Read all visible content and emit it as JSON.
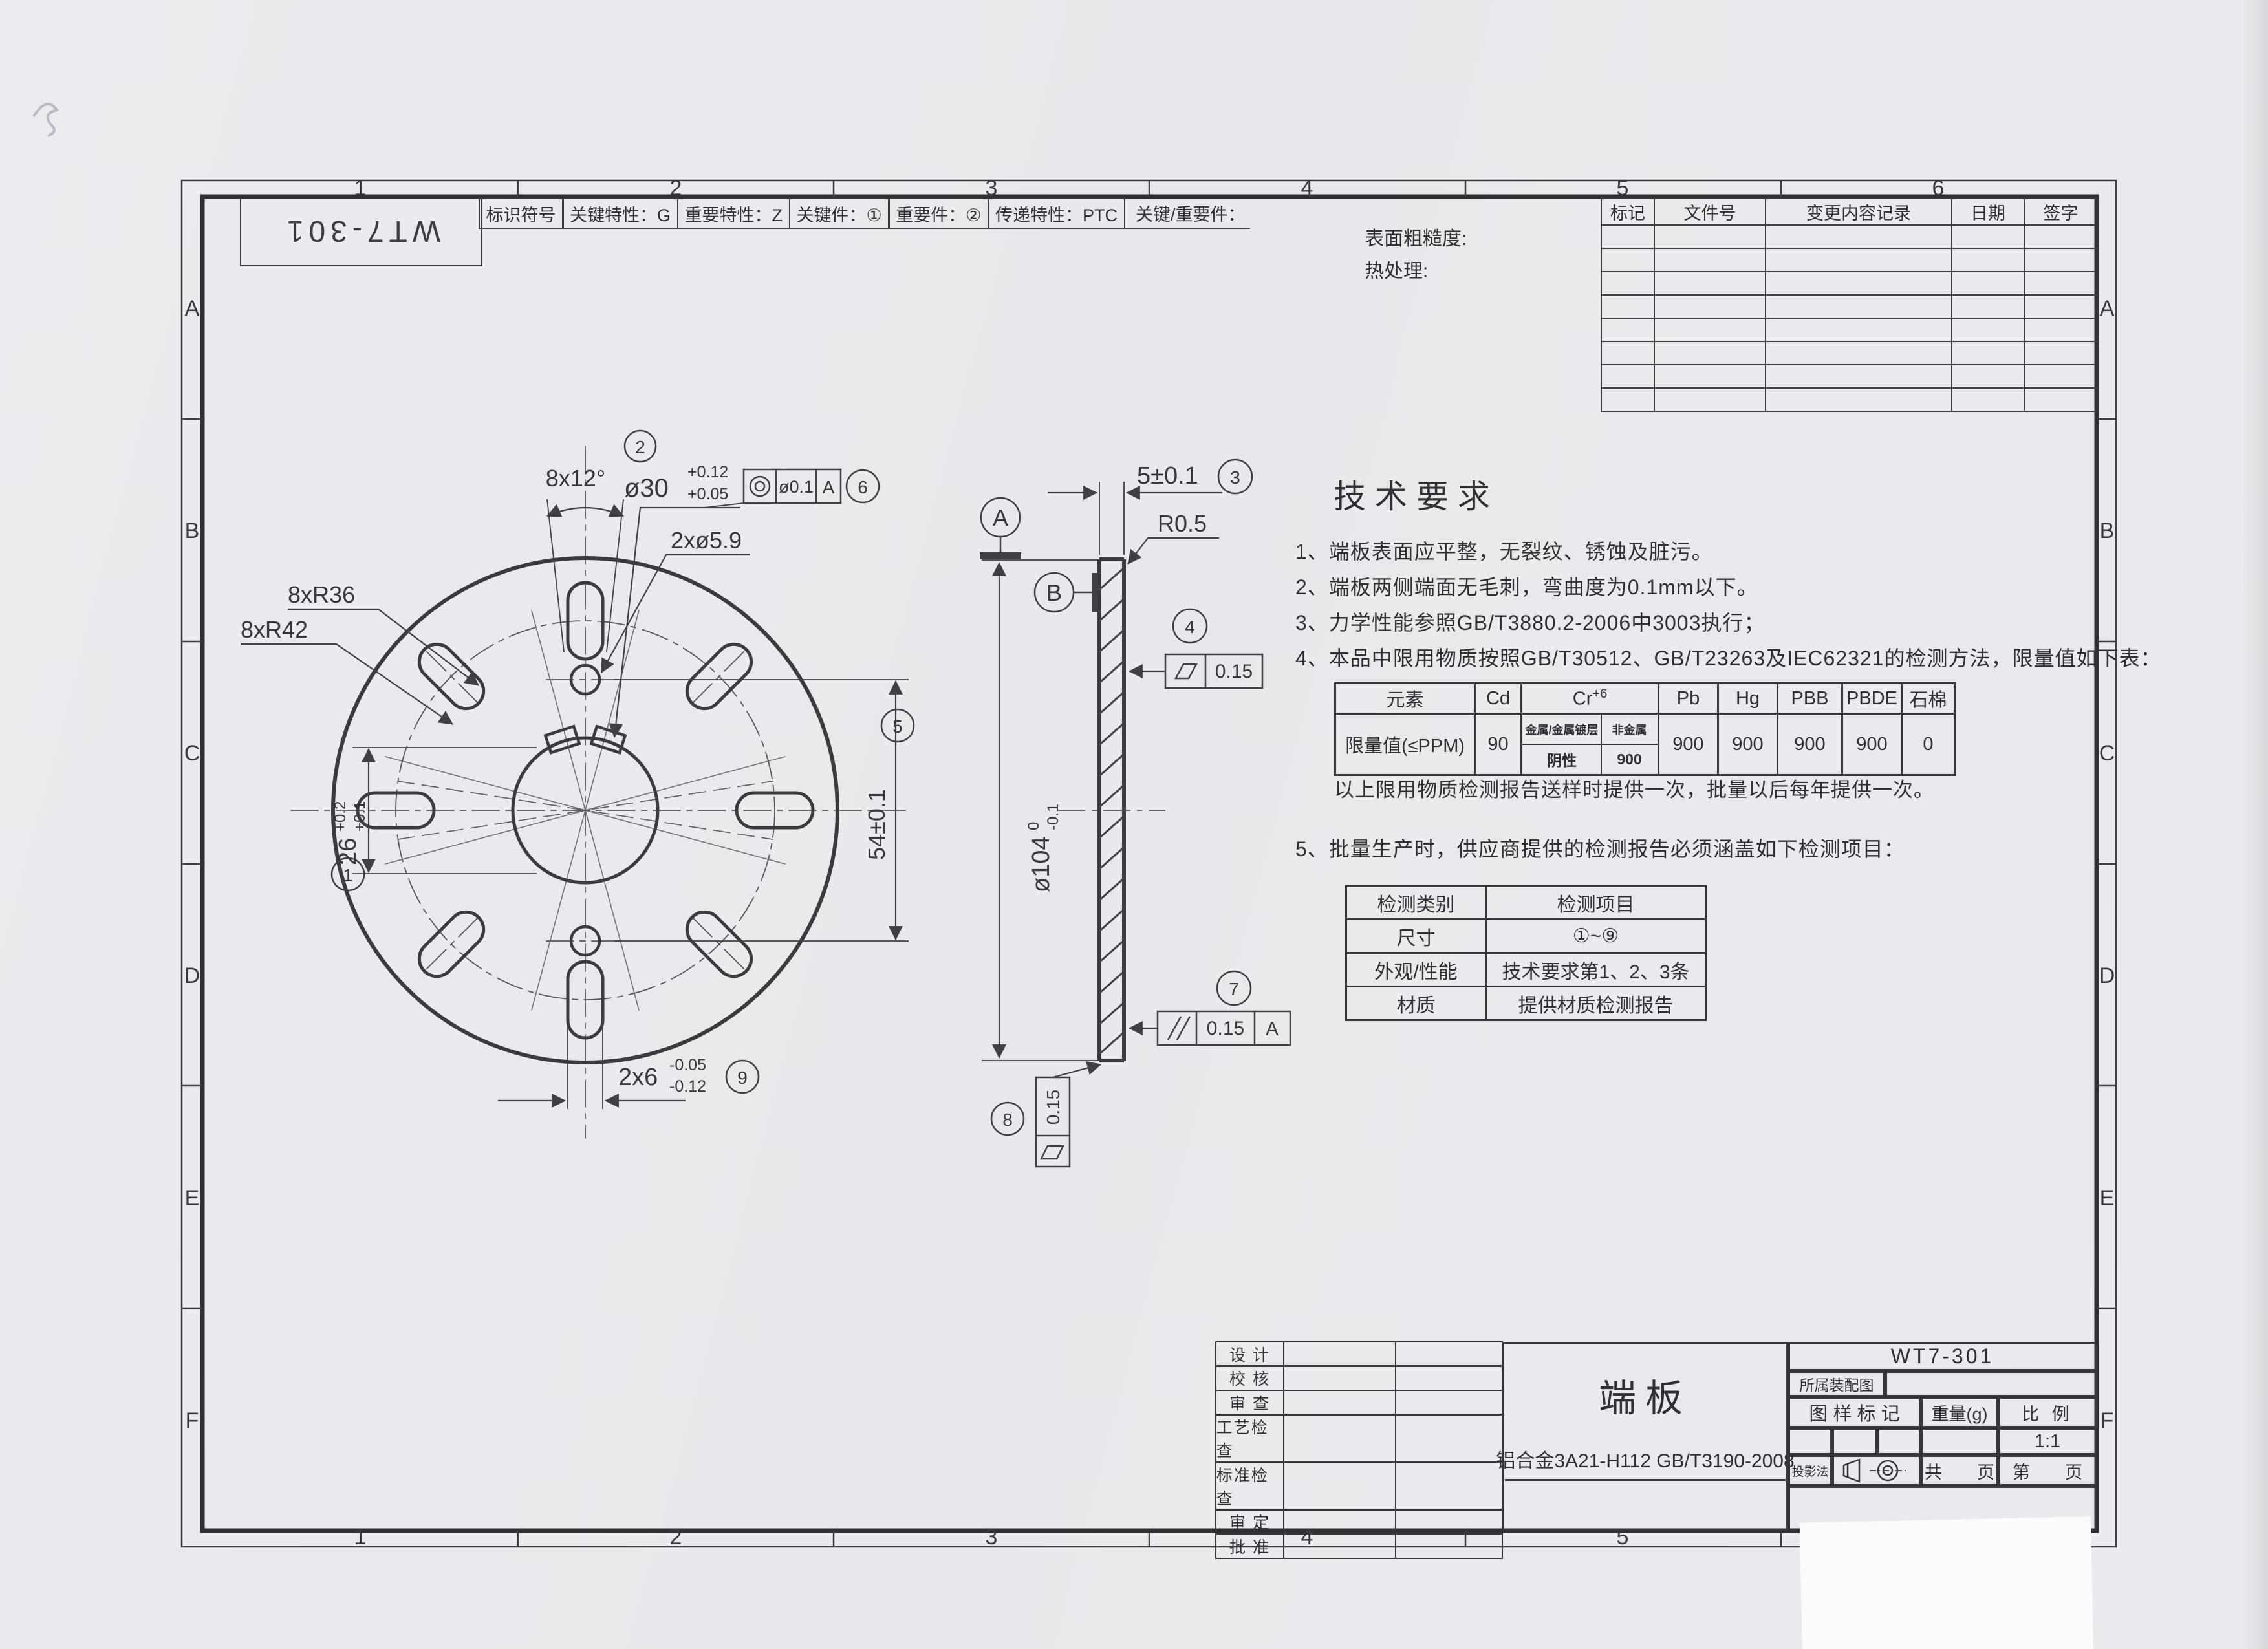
{
  "frame": {
    "zone_cols": [
      "1",
      "2",
      "3",
      "4",
      "5",
      "6"
    ],
    "zone_rows": [
      "A",
      "B",
      "C",
      "D",
      "E",
      "F"
    ],
    "corner_code": "WT7-301"
  },
  "header_strip": {
    "cells": [
      "标识符号",
      "关键特性：G",
      "重要特性：Z",
      "关键件：①",
      "重要件：②",
      "传递特性：PTC"
    ],
    "tail": "关键/重要件："
  },
  "revision_table": {
    "headers": [
      "标记",
      "文件号",
      "变更内容记录",
      "日期",
      "签字"
    ]
  },
  "notes_top": {
    "surface": "表面粗糙度:",
    "heat": "热处理:"
  },
  "tech_req": {
    "title": "技术要求",
    "items": [
      "1、端板表面应平整，无裂纹、锈蚀及脏污。",
      "2、端板两侧端面无毛刺，弯曲度为0.1mm以下。",
      "3、力学性能参照GB/T3880.2-2006中3003执行；",
      "4、本品中限用物质按照GB/T30512、GB/T23263及IEC62321的检测方法，限量值如下表："
    ],
    "item5": "5、批量生产时，供应商提供的检测报告必须涵盖如下检测项目："
  },
  "rohs_table": {
    "h_element": "元素",
    "h_cd": "Cd",
    "h_cr_base": "Cr",
    "h_cr_sup": "+6",
    "h_pb": "Pb",
    "h_hg": "Hg",
    "h_pbb": "PBB",
    "h_pbde": "PBDE",
    "h_asbestos": "石棉",
    "row_label": "限量值(≤PPM)",
    "cd_value": "90",
    "cr_sub_headers": [
      "金属/金属镀层",
      "非金属"
    ],
    "cr_values": [
      "阴性",
      "900"
    ],
    "values": [
      "900",
      "900",
      "900",
      "900",
      "0"
    ],
    "note": "以上限用物质检测报告送样时提供一次，批量以后每年提供一次。"
  },
  "inspection_table": {
    "headers": [
      "检测类别",
      "检测项目"
    ],
    "rows": [
      [
        "尺寸",
        "①~⑨"
      ],
      [
        "外观/性能",
        "技术要求第1、2、3条"
      ],
      [
        "材质",
        "提供材质检测报告"
      ]
    ]
  },
  "title_block": {
    "sig_rows": [
      "设 计",
      "校 核",
      "审 查",
      "工艺检查",
      "标准检查",
      "审 定",
      "批 准"
    ],
    "part_name": "端板",
    "material": "铝合金3A21-H112 GB/T3190-2008",
    "drawing_no": "WT7-301",
    "assembly_label": "所属装配图",
    "mark_label": "图 样 标 记",
    "weight_label": "重量(g)",
    "scale_label": "比 例",
    "scale_value": "1:1",
    "projection_label": "投影法",
    "pages_total": "共　　页",
    "page_no": "第　　页"
  },
  "dims": {
    "slot_angle": "8x12°",
    "bore_balloon": "2",
    "bore_dim": "ø30",
    "bore_tol_up": "+0.12",
    "bore_tol_dn": "+0.05",
    "conc_tol": "ø0.1",
    "conc_datum": "A",
    "conc_balloon": "6",
    "holes_dim": "2xø5.9",
    "slot_r_inner": "8xR36",
    "slot_r_outer": "8xR42",
    "key_balloon": "1",
    "key_dim": "26",
    "key_tol_up": "+0.2",
    "key_tol_dn": "+0.1",
    "bc_balloon": "5",
    "bc_dim": "54±0.1",
    "slot_w_dim": "2x6",
    "slot_w_tol_up": "-0.05",
    "slot_w_tol_dn": "-0.12",
    "slot_w_balloon": "9",
    "thick_dim": "5±0.1",
    "thick_balloon": "3",
    "edge_r": "R0.5",
    "datum_a": "A",
    "datum_b": "B",
    "flat1_tol": "0.15",
    "flat1_balloon": "4",
    "od_dim": "ø104",
    "od_tol_up": "0",
    "od_tol_dn": "-0.1",
    "par_tol": "0.15",
    "par_datum": "A",
    "par_balloon": "7",
    "flat2_tol": "0.15",
    "flat2_balloon": "8"
  }
}
